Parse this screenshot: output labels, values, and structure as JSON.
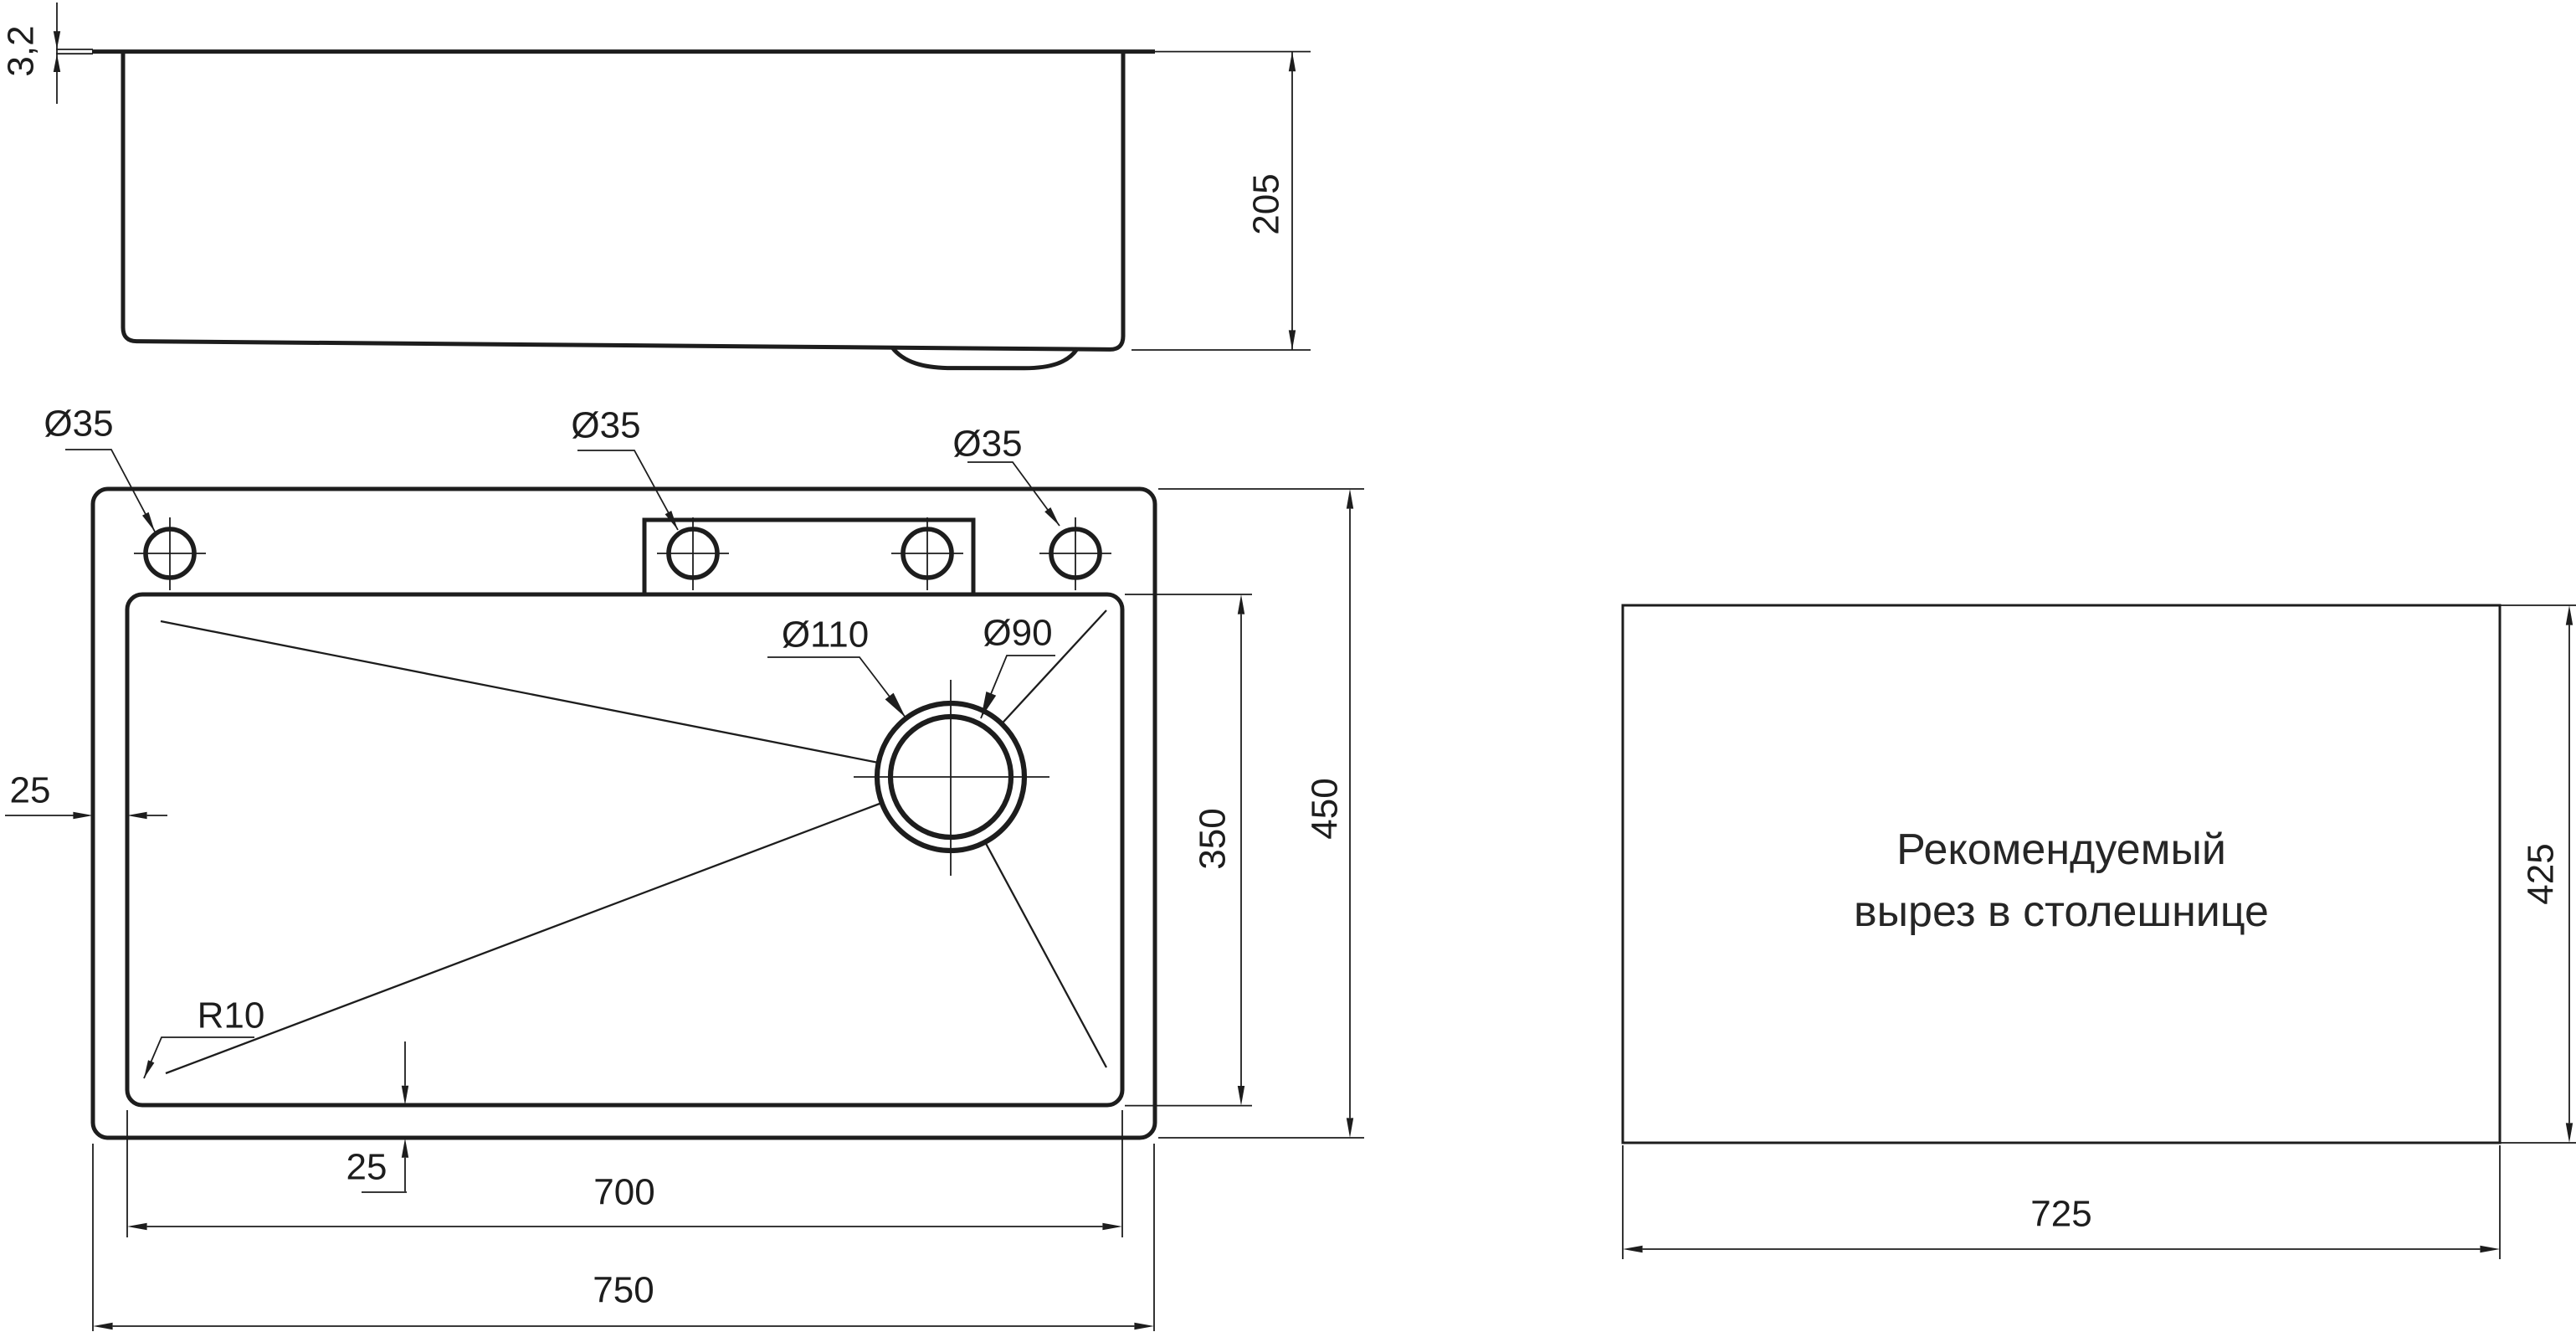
{
  "figure": {
    "background": "#ffffff",
    "line_color": "#1d1d1d",
    "description": "Technical dimension drawing of a kitchen sink: side view, plan view and recommended countertop cutout"
  },
  "side_view": {
    "rim_thickness_label": "3,2",
    "height_label": "205"
  },
  "plan_view": {
    "hole1_label": "Ø35",
    "hole2_label": "Ø35",
    "hole3_label": "Ø35",
    "drain_outer_label": "Ø110",
    "drain_inner_label": "Ø90",
    "left_inset_label": "25",
    "bottom_inset_label": "25",
    "corner_radius_label": "R10",
    "bowl_width_label": "700",
    "overall_width_label": "750",
    "bowl_depth_label": "350",
    "overall_depth_label": "450"
  },
  "cutout": {
    "note_line1": "Рекомендуемый",
    "note_line2": "вырез в столешнице",
    "width_label": "725",
    "height_label": "425"
  }
}
